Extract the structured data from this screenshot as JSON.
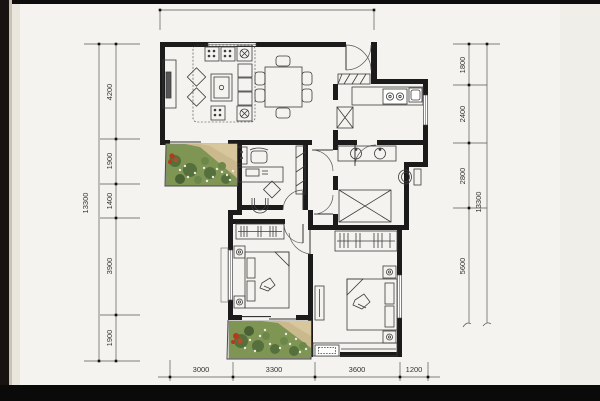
{
  "document": {
    "type": "apartment-floor-plan-scan",
    "visible_text_is_dimensions_only": true
  },
  "dims": {
    "left": {
      "total": "13300",
      "segments": [
        "4200",
        "1900",
        "1400",
        "3900",
        "1900"
      ]
    },
    "right": {
      "total": "13300",
      "segments": [
        "1800",
        "2400",
        "2800",
        "5600"
      ]
    },
    "bottom": {
      "segments": [
        "3000",
        "3300",
        "3600",
        "1200"
      ]
    }
  },
  "rooms": [
    "living-dining-room",
    "entry",
    "kitchen",
    "bathroom",
    "shower-room",
    "study-room",
    "second-bedroom",
    "master-bedroom",
    "living-balcony-garden",
    "bedroom-balcony-garden",
    "hallway"
  ],
  "furniture": [
    "tv-cabinet",
    "sofa-set",
    "coffee-table",
    "dining-table-six-chairs",
    "shoe-cabinet",
    "stove",
    "kitchen-counter",
    "fridge",
    "double-sink-vanity",
    "toilet",
    "shower-stall",
    "wash-basin",
    "desk",
    "office-chair",
    "bookshelf",
    "double-bed",
    "nightstand-lamps",
    "wardrobe-hangers",
    "dresser",
    "ac-unit-box",
    "bay-sill"
  ],
  "colors": {
    "paper": "#f4f3ef",
    "photo_frame": "#0d0c0a",
    "wall": "#1b1b1b",
    "furniture_line": "#3c3c3c",
    "dimension_line": "#555555",
    "garden_green": "#7e9554",
    "garden_dark_green": "#55703c",
    "garden_sand": "#cbb98e",
    "flower_red": "#b5391f",
    "flower_white": "#eceadf"
  }
}
